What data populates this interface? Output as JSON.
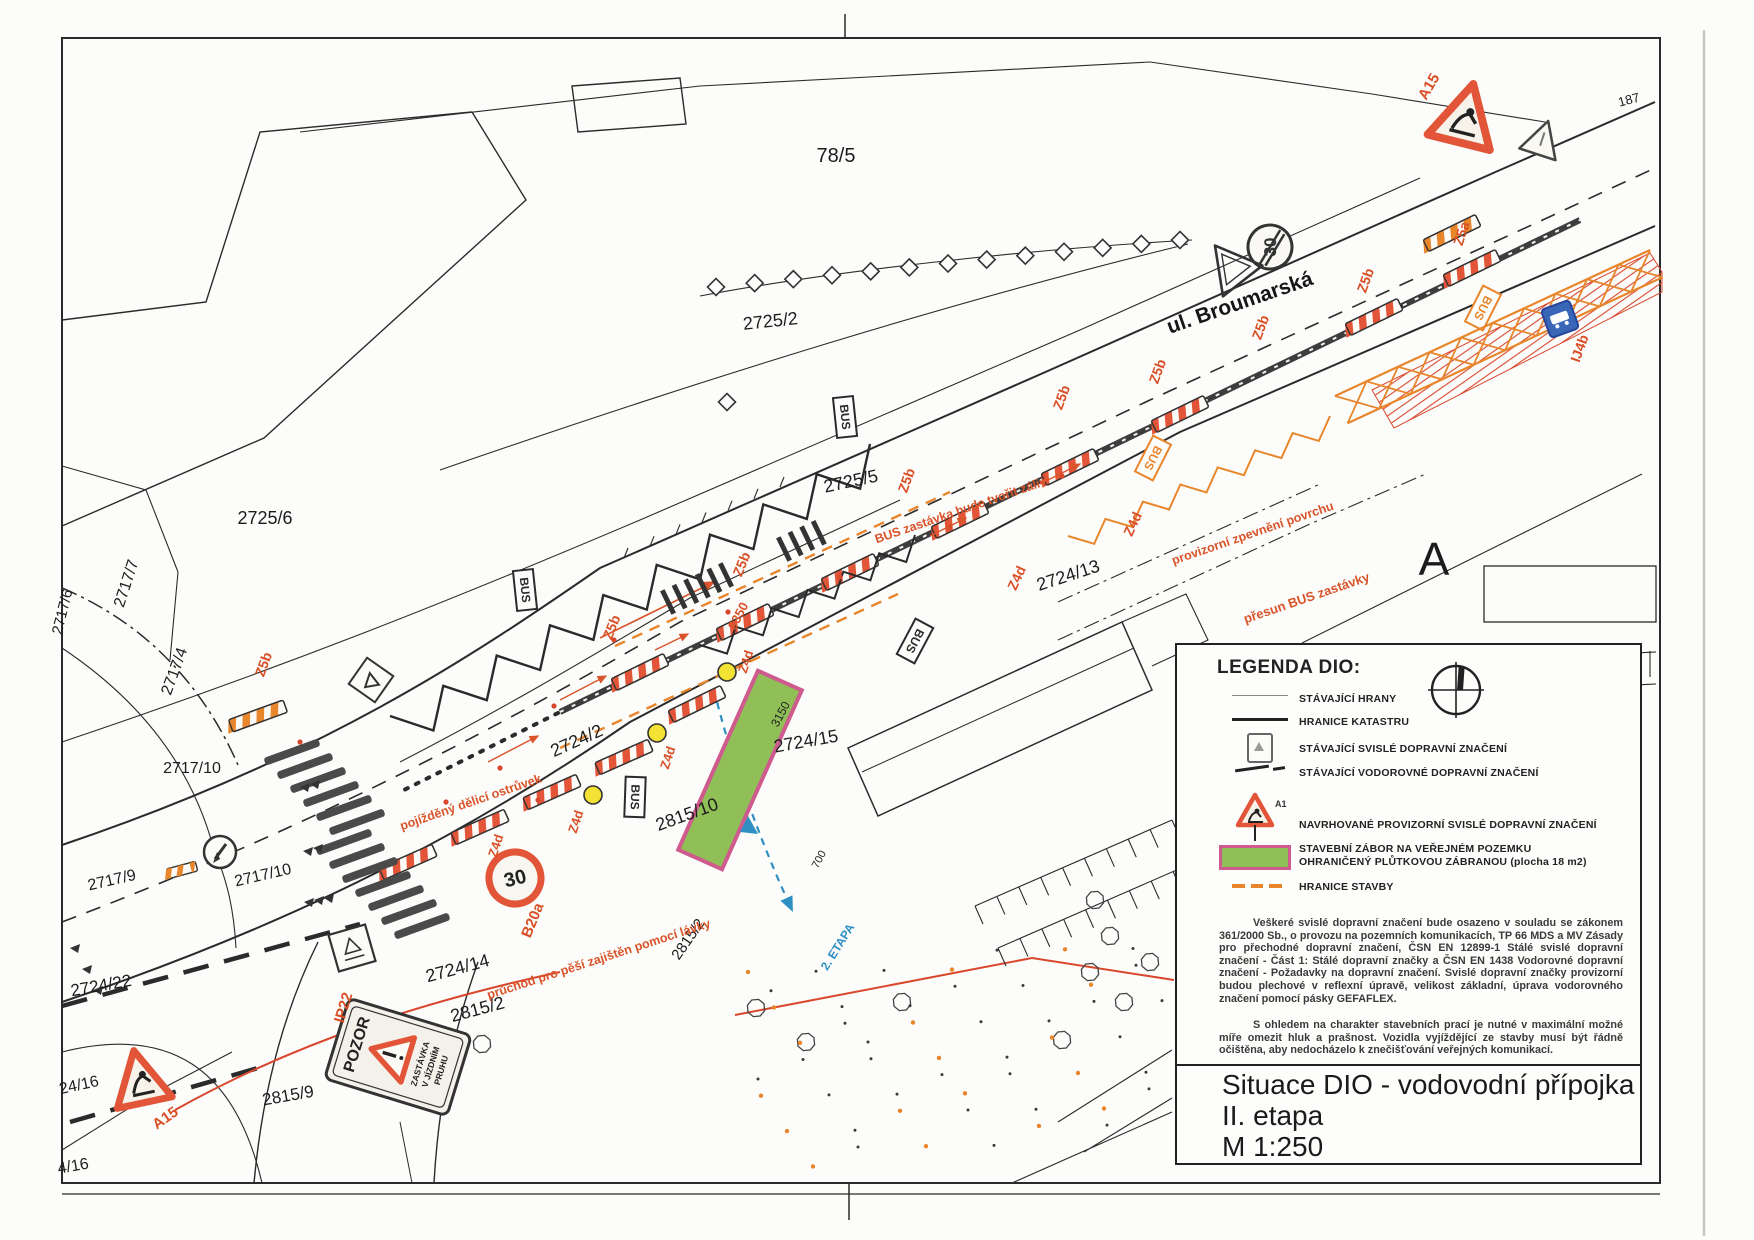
{
  "title_block": {
    "line1": "Situace DIO - vodovodní přípojka",
    "line2": "II. etapa",
    "line3": "M 1:250"
  },
  "legend": {
    "heading": "LEGENDA DIO:",
    "items": [
      {
        "label": "STÁVAJÍCÍ HRANY"
      },
      {
        "label": "HRANICE KATASTRU"
      },
      {
        "label": "STÁVAJÍCÍ SVISLÉ DOPRAVNÍ ZNAČENÍ"
      },
      {
        "label": "STÁVAJÍCÍ VODOROVNÉ DOPRAVNÍ ZNAČENÍ"
      },
      {
        "label": "NAVRHOVANÉ PROVIZORNÍ SVISLÉ DOPRAVNÍ ZNAČENÍ",
        "symbol_code": "A15"
      },
      {
        "label": "STAVEBNÍ ZÁBOR NA VEŘEJNÉM POZEMKU",
        "label2": "OHRANIČENÝ PLŮTKOVOU ZÁBRANOU (plocha 18 m2)"
      },
      {
        "label": "HRANICE STAVBY"
      }
    ],
    "paragraph1": "Veškeré svislé dopravní značení bude osazeno v souladu se zákonem 361/2000 Sb., o provozu na pozemních komunikacích, TP 66 MDS a MV Zásady pro přechodné dopravní značení, ČSN EN 12899-1 Stálé svislé dopravní značení - Část 1: Stálé dopravní značky a ČSN EN 1438 Vodorovné dopravní značení - Požadavky na dopravní značení. Svislé dopravní značky provizorní budou plechové v reflexní úpravě, velikost základní, úprava vodorovného značení pomocí pásky GEFAFLEX.",
    "paragraph2": "S ohledem na charakter stavebních prací je nutné v maximální možné míře omezit hluk a prašnost. Vozidla vyjíždějící ze stavby musí být řádně očištěna, aby nedocházelo k znečišťování veřejných komunikací."
  },
  "map": {
    "street_label": {
      "t": "ul. Broumarská",
      "x": 1242,
      "y": 309,
      "r": -19,
      "s": 21
    },
    "area_label": {
      "t": "A",
      "x": 1434,
      "y": 575,
      "r": 0,
      "s": 46
    },
    "corner_label": {
      "t": "187",
      "x": 1630,
      "y": 104,
      "r": -15,
      "s": 13
    },
    "parcel_labels": [
      {
        "t": "78/5",
        "x": 836,
        "y": 162,
        "r": 0,
        "s": 20
      },
      {
        "t": "2725/2",
        "x": 771,
        "y": 327,
        "r": -6,
        "s": 18
      },
      {
        "t": "2725/6",
        "x": 265,
        "y": 524,
        "r": 0,
        "s": 18
      },
      {
        "t": "2725/5",
        "x": 852,
        "y": 487,
        "r": -12,
        "s": 18
      },
      {
        "t": "2717/7",
        "x": 131,
        "y": 585,
        "r": -72,
        "s": 16
      },
      {
        "t": "2717/6",
        "x": 67,
        "y": 613,
        "r": -76,
        "s": 15
      },
      {
        "t": "2717/4",
        "x": 179,
        "y": 673,
        "r": -70,
        "s": 16
      },
      {
        "t": "2717/10",
        "x": 192,
        "y": 773,
        "r": 0,
        "s": 16
      },
      {
        "t": "2717/9",
        "x": 113,
        "y": 885,
        "r": -13,
        "s": 16
      },
      {
        "t": "2717/10",
        "x": 264,
        "y": 880,
        "r": -13,
        "s": 16
      },
      {
        "t": "2724/22",
        "x": 102,
        "y": 991,
        "r": -10,
        "s": 17
      },
      {
        "t": "2724/2",
        "x": 579,
        "y": 746,
        "r": -24,
        "s": 18
      },
      {
        "t": "2724/15",
        "x": 807,
        "y": 747,
        "r": -10,
        "s": 18
      },
      {
        "t": "2724/13",
        "x": 1070,
        "y": 581,
        "r": -18,
        "s": 18
      },
      {
        "t": "2724/14",
        "x": 459,
        "y": 974,
        "r": -15,
        "s": 18
      },
      {
        "t": "2815/10",
        "x": 689,
        "y": 820,
        "r": -20,
        "s": 18
      },
      {
        "t": "2815/2",
        "x": 479,
        "y": 1015,
        "r": -15,
        "s": 18
      },
      {
        "t": "2815/2",
        "x": 692,
        "y": 942,
        "r": -55,
        "s": 15
      },
      {
        "t": "2815/9",
        "x": 289,
        "y": 1101,
        "r": -10,
        "s": 17
      },
      {
        "t": "24/16",
        "x": 80,
        "y": 1090,
        "r": -12,
        "s": 16
      },
      {
        "t": "4/16",
        "x": 74,
        "y": 1171,
        "r": -10,
        "s": 16
      }
    ],
    "sign_codes": [
      {
        "t": "A15",
        "x": 1433,
        "y": 89,
        "r": -60,
        "s": 15
      },
      {
        "t": "Z5a",
        "x": 1466,
        "y": 235,
        "r": -72,
        "s": 14
      },
      {
        "t": "Z5b",
        "x": 1370,
        "y": 282,
        "r": -70,
        "s": 14
      },
      {
        "t": "Z5b",
        "x": 1265,
        "y": 329,
        "r": -70,
        "s": 14
      },
      {
        "t": "Z5b",
        "x": 1162,
        "y": 373,
        "r": -70,
        "s": 14
      },
      {
        "t": "Z5b",
        "x": 1066,
        "y": 399,
        "r": -70,
        "s": 14
      },
      {
        "t": "Z5b",
        "x": 911,
        "y": 482,
        "r": -70,
        "s": 14
      },
      {
        "t": "Z5b",
        "x": 746,
        "y": 566,
        "r": -68,
        "s": 14
      },
      {
        "t": "Z5b",
        "x": 616,
        "y": 629,
        "r": -68,
        "s": 14
      },
      {
        "t": "Z5b",
        "x": 268,
        "y": 666,
        "r": -70,
        "s": 14
      },
      {
        "t": "Z4d",
        "x": 1137,
        "y": 526,
        "r": -65,
        "s": 14
      },
      {
        "t": "Z4d",
        "x": 1021,
        "y": 580,
        "r": -65,
        "s": 14
      },
      {
        "t": "Z4d",
        "x": 750,
        "y": 663,
        "r": -72,
        "s": 13
      },
      {
        "t": "Z4d",
        "x": 672,
        "y": 759,
        "r": -72,
        "s": 13
      },
      {
        "t": "Z4d",
        "x": 580,
        "y": 823,
        "r": -72,
        "s": 13
      },
      {
        "t": "Z4d",
        "x": 500,
        "y": 847,
        "r": -72,
        "s": 13
      },
      {
        "t": "B20a",
        "x": 537,
        "y": 922,
        "r": -68,
        "s": 15
      },
      {
        "t": "IP22",
        "x": 348,
        "y": 1009,
        "r": -73,
        "s": 15
      },
      {
        "t": "A15",
        "x": 168,
        "y": 1122,
        "r": -35,
        "s": 15
      },
      {
        "t": "IJ4b",
        "x": 1584,
        "y": 350,
        "r": -70,
        "s": 14
      }
    ],
    "annotations": [
      {
        "t": "přesun BUS zastávky",
        "x": 1308,
        "y": 602,
        "r": -19,
        "s": 13
      },
      {
        "t": "provizorní zpevnění povrchu",
        "x": 1254,
        "y": 537,
        "r": -19,
        "s": 12.5
      },
      {
        "t": "BUS zastávka bude tvořit záliv",
        "x": 962,
        "y": 514,
        "r": -19,
        "s": 12.5
      },
      {
        "t": "pojížděný dělicí ostrůvek",
        "x": 472,
        "y": 806,
        "r": -19,
        "s": 12.5
      },
      {
        "t": "průchod pro pěší zajištěn pomocí lávky",
        "x": 600,
        "y": 963,
        "r": -18,
        "s": 12.5
      }
    ],
    "blue_annotation": {
      "t": "2. ETAPA",
      "x": 841,
      "y": 949,
      "r": -58,
      "s": 12
    },
    "dimensions": [
      {
        "t": "3350",
        "x": 742,
        "y": 618,
        "r": -62,
        "s": 13,
        "o": true
      },
      {
        "t": "3150",
        "x": 784,
        "y": 716,
        "r": -62,
        "s": 12
      },
      {
        "t": "700",
        "x": 822,
        "y": 861,
        "r": -62,
        "s": 11
      }
    ],
    "bus_stops": [
      {
        "x": 845,
        "y": 417,
        "r": -6,
        "c": "ink"
      },
      {
        "x": 525,
        "y": 590,
        "r": -6,
        "c": "ink"
      },
      {
        "x": 915,
        "y": 641,
        "r": 28,
        "c": "ink"
      },
      {
        "x": 635,
        "y": 797,
        "r": 2,
        "c": "ink"
      },
      {
        "x": 1483,
        "y": 308,
        "r": 27,
        "c": "structure"
      },
      {
        "x": 1153,
        "y": 458,
        "r": 27,
        "c": "structure"
      }
    ],
    "bus_text": "BUS",
    "signs": {
      "speed30": "30",
      "speed30_end": "30",
      "pozor_title": "POZOR",
      "pozor_line1": "ZASTÁVKA",
      "pozor_line2": "V JÍZDNÍM",
      "pozor_line3": "PRUHU",
      "legend_a15_code": "A15"
    }
  },
  "colors": {
    "ink": "#2b2b2b",
    "annotation": "#d9542a",
    "structure": "#e8862c",
    "barrier": "#e25538",
    "hatch": "#d9482e",
    "green_zone": "#8fbf56",
    "zone_border": "#cf5a8e",
    "lamp_yellow": "#f2e233",
    "sign_blue": "#3a66b8",
    "pipe_blue": "#2e8fc2"
  }
}
